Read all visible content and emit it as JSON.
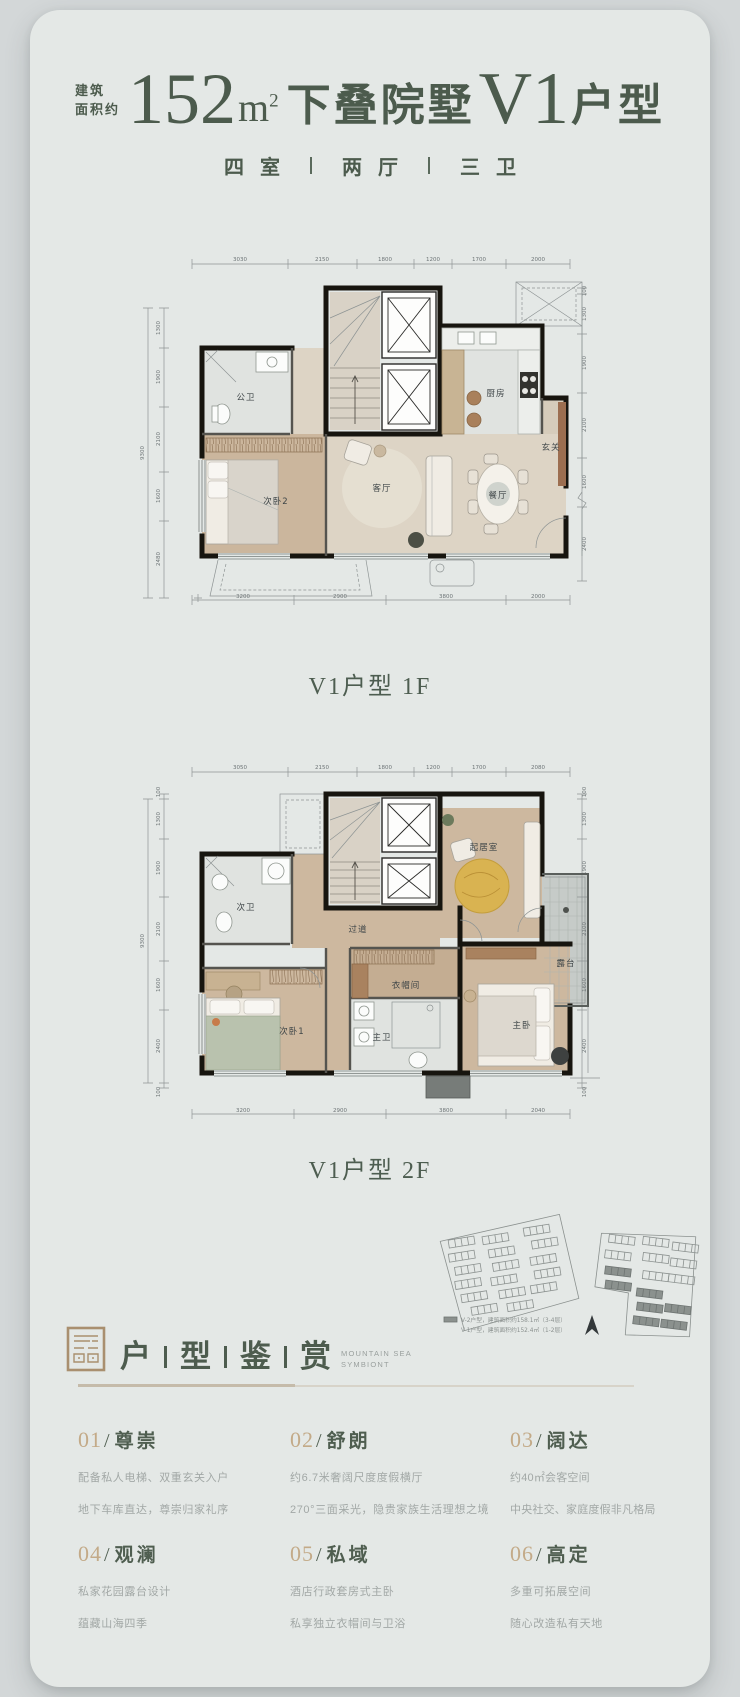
{
  "colors": {
    "accent_green": "#4c5b4d",
    "accent_tan": "#c3aa88",
    "card_bg": "#e4e8e6",
    "page_bg": "#d3d7d8"
  },
  "header": {
    "area_prefix_line1": "建筑",
    "area_prefix_line2": "面积约",
    "area_number": "152",
    "area_unit_m": "m",
    "area_unit_sup": "2",
    "title_mid": "下叠院墅",
    "title_code": "V1",
    "title_suffix": "户型",
    "subtitle_parts": [
      "四室",
      "两厅",
      "三卫"
    ]
  },
  "plan1f": {
    "caption": "V1户型 1F",
    "dims_top": [
      "3030",
      "2150",
      "1800",
      "1200",
      "1700",
      "2000"
    ],
    "dims_left": [
      "1300",
      "1900",
      "2100",
      "1600",
      "2480"
    ],
    "dims_left_total": "9300",
    "dims_right": [
      "100",
      "1300",
      "1900",
      "2100",
      "1600",
      "2400"
    ],
    "dims_bottom": [
      "3200",
      "2900",
      "3800",
      "2000"
    ],
    "rooms": {
      "bath": "公卫",
      "bedroom2": "次卧2",
      "living": "客厅",
      "dining": "餐厅",
      "foyer": "玄关",
      "kitchen": "厨房"
    }
  },
  "plan2f": {
    "caption": "V1户型 2F",
    "dims_top": [
      "3050",
      "2150",
      "1800",
      "1200",
      "1700",
      "2080"
    ],
    "dims_left": [
      "100",
      "1300",
      "1900",
      "2100",
      "1600",
      "2400",
      "100"
    ],
    "dims_left_total": "9300",
    "dims_right": [
      "100",
      "1300",
      "1900",
      "2100",
      "1600",
      "2400",
      "100"
    ],
    "dims_bottom": [
      "3200",
      "2900",
      "3800",
      "2040"
    ],
    "rooms": {
      "bath2": "次卫",
      "corridor": "过道",
      "family": "起居室",
      "closet": "衣帽间",
      "masterbath": "主卫",
      "bedroom1": "次卧1",
      "master": "主卧",
      "terrace": "露台"
    }
  },
  "siteplan": {
    "legend_line1": "V-2户型，建筑面积约158.1㎡（3-4层）",
    "legend_line2": "V-1户型，建筑面积约152.4㎡（1-2层）"
  },
  "section": {
    "chars": [
      "户",
      "型",
      "鉴",
      "赏"
    ],
    "en_line1": "MOUNTAIN SEA",
    "en_line2": "SYMBIONT"
  },
  "features_meta": {
    "slash": "/"
  },
  "features": [
    {
      "num": "01",
      "name": "尊崇",
      "line1": "配备私人电梯、双重玄关入户",
      "line2": "地下车库直达，尊崇归家礼序"
    },
    {
      "num": "02",
      "name": "舒朗",
      "line1": "约6.7米奢阔尺度度假横厅",
      "line2": "270°三面采光，隐贵家族生活理想之境"
    },
    {
      "num": "03",
      "name": "阔达",
      "line1": "约40㎡会客空间",
      "line2": "中央社交、家庭度假非凡格局"
    },
    {
      "num": "04",
      "name": "观澜",
      "line1": "私家花园露台设计",
      "line2": "蕴藏山海四季"
    },
    {
      "num": "05",
      "name": "私域",
      "line1": "酒店行政套房式主卧",
      "line2": "私享独立衣帽间与卫浴"
    },
    {
      "num": "06",
      "name": "高定",
      "line1": "多重可拓展空间",
      "line2": "随心改造私有天地"
    }
  ]
}
